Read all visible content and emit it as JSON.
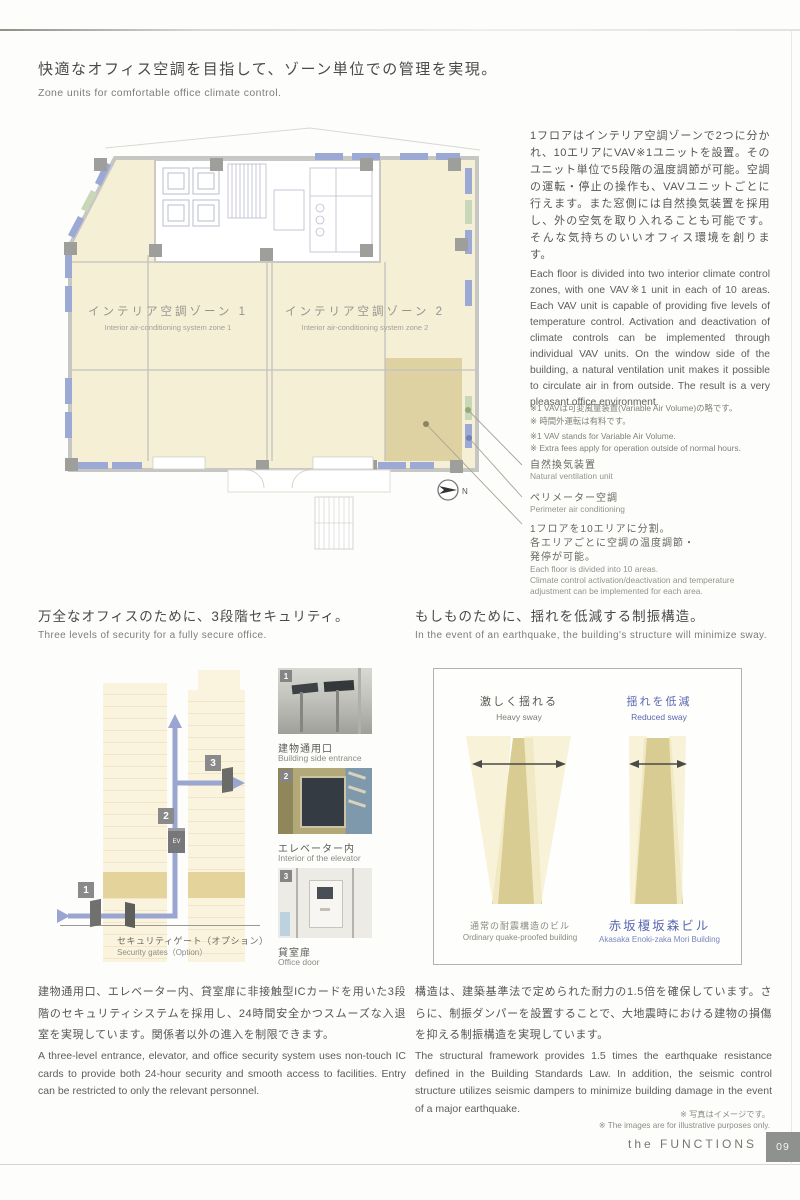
{
  "climate": {
    "heading_jp": "快適なオフィス空調を目指して、ゾーン単位での管理を実現。",
    "heading_en": "Zone units for comfortable office climate control.",
    "plan": {
      "zone1_jp": "インテリア空調ゾーン 1",
      "zone1_en": "Interior air-conditioning system zone 1",
      "zone2_jp": "インテリア空調ゾーン 2",
      "zone2_en": "Interior air-conditioning system zone 2",
      "compass_label": "N"
    },
    "body_jp": "1フロアはインテリア空調ゾーンで2つに分かれ、10エリアにVAV※1ユニットを設置。そのユニット単位で5段階の温度調節が可能。空調の運転・停止の操作も、VAVユニットごとに行えます。また窓側には自然換気装置を採用し、外の空気を取り入れることも可能です。そんな気持ちのいいオフィス環境を創ります。",
    "body_en": "Each floor is divided into two interior climate control zones, with one VAV※1 unit in each of 10 areas. Each VAV unit is capable of providing five levels of temperature control. Activation and deactivation of climate controls can be implemented through individual VAV units. On the window side of the building, a natural ventilation unit makes it possible to circulate air in from outside. The result is a very pleasant office environment.",
    "note_jp_1": "※1 VAVは可変風量装置(Variable Air Volume)の略です。",
    "note_jp_2": "※ 時間外運転は有料です。",
    "note_en_1": "※1 VAV stands for Variable Air Volume.",
    "note_en_2": "※ Extra fees apply for operation outside of normal hours.",
    "ann1_jp": "自然換気装置",
    "ann1_en": "Natural ventilation unit",
    "ann2_jp": "ペリメーター空調",
    "ann2_en": "Perimeter air conditioning",
    "ann3_jp_l1": "1フロアを10エリアに分割。",
    "ann3_jp_l2": "各エリアごとに空調の温度調節・",
    "ann3_jp_l3": "発停が可能。",
    "ann3_en_l1": "Each floor is divided into 10 areas.",
    "ann3_en_l2": "Climate control activation/deactivation and temperature",
    "ann3_en_l3": "adjustment can be implemented for each area."
  },
  "security": {
    "heading_jp": "万全なオフィスのために、3段階セキュリティ。",
    "heading_en": "Three levels of security for a fully secure office.",
    "diagram": {
      "badge1": "1",
      "badge2": "2",
      "badge3": "3",
      "ev_label": "EV",
      "gate_label_jp": "セキュリティゲート（オプション）",
      "gate_label_en": "Security gates（Option）"
    },
    "photos": [
      {
        "num": "1",
        "jp": "建物通用口",
        "en": "Building side entrance"
      },
      {
        "num": "2",
        "jp": "エレベーター内",
        "en": "Interior of the elevator"
      },
      {
        "num": "3",
        "jp": "貸室扉",
        "en": "Office door"
      }
    ],
    "body_jp": "建物通用口、エレベーター内、貸室扉に非接触型ICカードを用いた3段階のセキュリティシステムを採用し、24時間安全かつスムーズな入退室を実現しています。関係者以外の進入を制限できます。",
    "body_en": "A three-level entrance, elevator, and office security system uses non-touch IC cards to provide both 24-hour security and smooth access to facilities. Entry can be restricted to only the relevant personnel."
  },
  "seismic": {
    "heading_jp": "もしものために、揺れを低減する制振構造。",
    "heading_en": "In the event of an earthquake, the building's structure will minimize sway.",
    "diagram": {
      "left_title_jp": "激しく揺れる",
      "left_title_en": "Heavy sway",
      "right_title_jp": "揺れを低減",
      "right_title_en": "Reduced sway",
      "left_caption_jp": "通常の耐震構造のビル",
      "left_caption_en": "Ordinary quake-proofed building",
      "right_caption_jp": "赤坂榎坂森ビル",
      "right_caption_en": "Akasaka Enoki-zaka Mori Building"
    },
    "body_jp": "構造は、建築基準法で定められた耐力の1.5倍を確保しています。さらに、制振ダンパーを設置することで、大地震時における建物の損傷を抑える制振構造を実現しています。",
    "body_en": "The structural framework provides 1.5 times the earthquake resistance defined in the Building Standards Law. In addition, the seismic control structure utilizes seismic dampers to minimize building damage in the event of a major earthquake."
  },
  "notes": {
    "photo_note_jp": "※ 写真はイメージです。",
    "photo_note_en": "※ The images are for illustrative purposes only."
  },
  "footer": {
    "brand": "the FUNCTIONS",
    "page_number": "09"
  }
}
